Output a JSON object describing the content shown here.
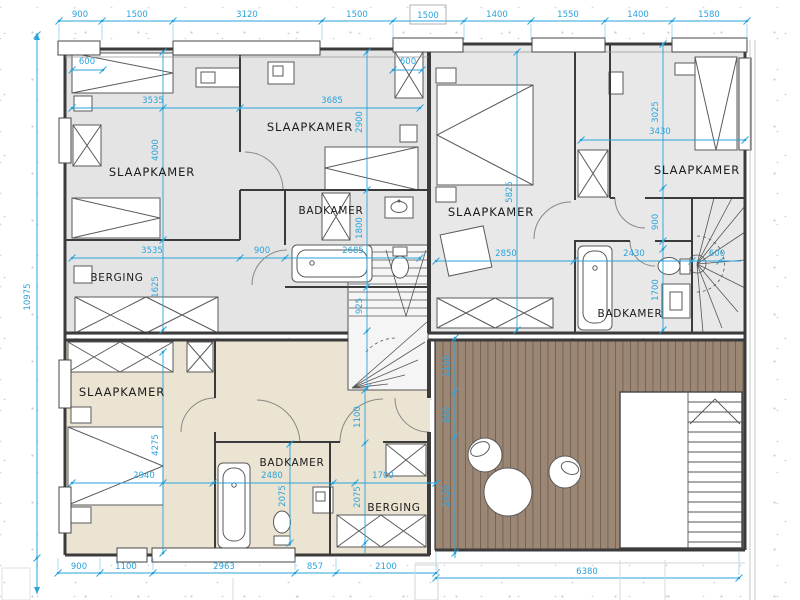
{
  "drawing": {
    "type": "floor-plan",
    "language": "nl"
  },
  "colors": {
    "dimension_cyan": "#29A3DC",
    "wall": "#3B3B3B",
    "room_fill_gray": "#E4E4E4",
    "room_fill_beige": "#ECE4D2",
    "deck_brown": "#9C8775",
    "background": "#FFFFFF"
  },
  "rooms": {
    "upper_left_bedroom": "SLAAPKAMER",
    "upper_mid_bedroom": "SLAAPKAMER",
    "upper_bathroom": "BADKAMER",
    "upper_storage": "BERGING",
    "right_main_bedroom": "SLAAPKAMER",
    "right_small_bedroom": "SLAAPKAMER",
    "right_bathroom": "BADKAMER",
    "lower_bedroom": "SLAAPKAMER",
    "lower_bathroom": "BADKAMER",
    "lower_storage": "BERGING"
  },
  "dimensions": {
    "top_row": [
      "900",
      "1500",
      "3120",
      "1500",
      "1500",
      "1400",
      "1550",
      "1400",
      "1580"
    ],
    "bottom_row": [
      "900",
      "1100",
      "2963",
      "857",
      "2100"
    ],
    "bottom_right_total": "6380",
    "left_total": "10975",
    "interior": {
      "ul_bed_600": "600",
      "ul_width_3535": "3535",
      "um_width_3685": "3685",
      "ul_height_4000": "4000",
      "um_closet_600": "600",
      "um_height_2900": "2900",
      "bath_height_1800": "1800",
      "storage_width_3535": "3535",
      "hall_width_900": "900",
      "bath_width_2685": "2685",
      "storage_height_1625": "1625",
      "landing_925": "925",
      "r_height_5825": "5825",
      "r_width_2850": "2850",
      "rs_height_3025": "3025",
      "rs_width_3430": "3430",
      "r_hall_900": "900",
      "rbath_width_2430": "2430",
      "stair_600": "600",
      "rbath_height_1700": "1700",
      "low_height_4275": "4275",
      "low_width_2940": "2940",
      "lbath_width_2480": "2480",
      "lbath_height_2075": "2075",
      "lhall_height_2075": "2075",
      "lstore_width_1700": "1700",
      "lhall_width_1100": "1100",
      "deck_a_1100": "1100",
      "deck_b_900": "900",
      "deck_c_2430": "2430"
    }
  }
}
